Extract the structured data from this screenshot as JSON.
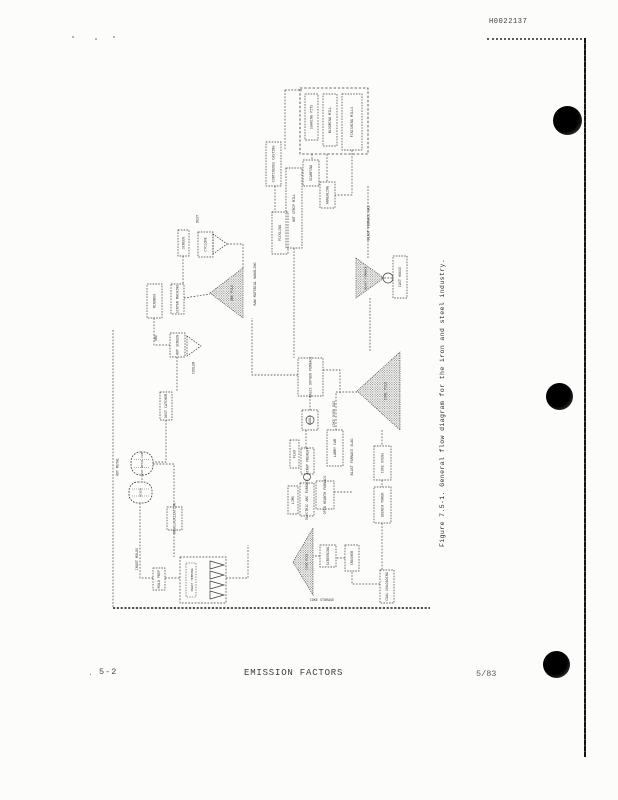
{
  "page": {
    "stamp": "H0022137",
    "caption": "Figure 7.5-1.  General flow diagram for the iron and steel industry.",
    "footer": {
      "stray": ".",
      "left": "5-2",
      "center": "EMISSION FACTORS",
      "right": "5/83"
    }
  },
  "colors": {
    "ink": "#3a3a3a",
    "paper": "#fcfcfb",
    "hole": "#1c1c1c"
  },
  "diagram": {
    "title": "General flow diagram for the iron and steel industry",
    "nodes": [
      {
        "id": "finishing-enclosure",
        "type": "enclosure",
        "x": 300,
        "y": 88,
        "w": 68,
        "h": 66
      },
      {
        "id": "soaking-pits",
        "type": "box",
        "x": 305,
        "y": 94,
        "w": 13,
        "h": 46,
        "label": "SOAKING PITS"
      },
      {
        "id": "blooming-mill",
        "type": "box",
        "x": 323,
        "y": 94,
        "w": 14,
        "h": 52,
        "label": "BLOOMING MILL"
      },
      {
        "id": "finishing-mills",
        "type": "box",
        "x": 342,
        "y": 94,
        "w": 20,
        "h": 56,
        "label": "FINISHING MILLS"
      },
      {
        "id": "scarfing",
        "type": "box",
        "x": 303,
        "y": 160,
        "w": 16,
        "h": 26,
        "label": "SCARFING"
      },
      {
        "id": "continuous-casting",
        "type": "box",
        "x": 266,
        "y": 142,
        "w": 15,
        "h": 44,
        "label": "CONTINUOUS CASTING"
      },
      {
        "id": "hot-strip-mill",
        "type": "box",
        "x": 286,
        "y": 168,
        "w": 16,
        "h": 80,
        "label": "HOT STRIP MILL"
      },
      {
        "id": "pickling",
        "type": "box",
        "x": 272,
        "y": 212,
        "w": 16,
        "h": 42,
        "label": "PICKLING"
      },
      {
        "id": "annealing",
        "type": "box",
        "x": 320,
        "y": 182,
        "w": 15,
        "h": 26,
        "label": "ANNEALING"
      },
      {
        "id": "dust-label",
        "type": "text",
        "x": 193,
        "y": 208,
        "w": 9,
        "h": 22,
        "label": "DUST"
      },
      {
        "id": "cyclone",
        "type": "box",
        "x": 198,
        "y": 232,
        "w": 15,
        "h": 25,
        "label": "CYCLONE"
      },
      {
        "id": "cyclone-cone",
        "type": "funnel",
        "points": [
          [
            213,
            234
          ],
          [
            213,
            254
          ],
          [
            227,
            244
          ]
        ]
      },
      {
        "id": "screen",
        "type": "box",
        "x": 178,
        "y": 230,
        "w": 11,
        "h": 26,
        "label": "SCREEN"
      },
      {
        "id": "windbox",
        "type": "box",
        "x": 147,
        "y": 284,
        "w": 15,
        "h": 34,
        "label": "WINDBOX"
      },
      {
        "id": "sinter-machine",
        "type": "box",
        "x": 171,
        "y": 284,
        "w": 13,
        "h": 30,
        "label": "SINTER MACHINE"
      },
      {
        "id": "ore-label",
        "type": "text",
        "x": 152,
        "y": 328,
        "w": 8,
        "h": 20,
        "label": "ORE"
      },
      {
        "id": "hot-screen",
        "type": "box",
        "x": 170,
        "y": 333,
        "w": 15,
        "h": 24,
        "label": "HOT SCREEN"
      },
      {
        "id": "sinter-cooler-cone",
        "type": "funnel",
        "points": [
          [
            187,
            336
          ],
          [
            187,
            356
          ],
          [
            201,
            346
          ]
        ]
      },
      {
        "id": "cooler-label",
        "type": "text",
        "x": 190,
        "y": 358,
        "w": 7,
        "h": 20,
        "label": "COOLER"
      },
      {
        "id": "ore-pile",
        "type": "pile",
        "points": [
          [
            210,
            293
          ],
          [
            243,
            268
          ],
          [
            243,
            318
          ]
        ],
        "label": "ORE PILE"
      },
      {
        "id": "material-handling-label",
        "type": "text",
        "x": 251,
        "y": 255,
        "w": 8,
        "h": 58,
        "label": "RAW MATERIAL HANDLING"
      },
      {
        "id": "blast-furnace",
        "type": "pile",
        "points": [
          [
            356,
            258
          ],
          [
            356,
            298
          ],
          [
            384,
            278
          ]
        ],
        "label": "BLAST FURNACE",
        "fs": 3
      },
      {
        "id": "hot-metal-circle",
        "type": "circle",
        "cx": 388,
        "cy": 278,
        "r": 5
      },
      {
        "id": "cast-house",
        "type": "box",
        "x": 393,
        "y": 256,
        "w": 14,
        "h": 42,
        "label": "CAST HOUSE"
      },
      {
        "id": "bf-gas-label",
        "type": "text",
        "x": 364,
        "y": 192,
        "w": 9,
        "h": 62,
        "label": "BLAST FURNACE GAS"
      },
      {
        "id": "dust-catcher",
        "type": "box",
        "x": 160,
        "y": 392,
        "w": 12,
        "h": 28,
        "label": "DUST CATCHER"
      },
      {
        "id": "coal-pile",
        "type": "pile",
        "points": [
          [
            357,
            391
          ],
          [
            400,
            352
          ],
          [
            400,
            430
          ]
        ],
        "label": "COAL PILE"
      },
      {
        "id": "larry-car",
        "type": "box",
        "x": 327,
        "y": 430,
        "w": 16,
        "h": 36,
        "label": "LARRY CAR"
      },
      {
        "id": "coke-ovens",
        "type": "box",
        "x": 374,
        "y": 446,
        "w": 17,
        "h": 34,
        "label": "COKE OVENS"
      },
      {
        "id": "quench-tower",
        "type": "box",
        "x": 374,
        "y": 487,
        "w": 17,
        "h": 36,
        "label": "QUENCH TOWER"
      },
      {
        "id": "coal-unloading",
        "type": "box",
        "x": 380,
        "y": 570,
        "w": 14,
        "h": 33,
        "label": "COAL UNLOADING"
      },
      {
        "id": "crusher",
        "type": "box",
        "x": 345,
        "y": 545,
        "w": 14,
        "h": 26,
        "label": "CRUSHER"
      },
      {
        "id": "screening",
        "type": "box",
        "x": 320,
        "y": 545,
        "w": 16,
        "h": 22,
        "label": "SCREENING"
      },
      {
        "id": "coke-pile",
        "type": "pile",
        "points": [
          [
            293,
            562
          ],
          [
            313,
            528
          ],
          [
            313,
            595
          ]
        ],
        "label": "COKE PILE",
        "fs": 3
      },
      {
        "id": "coke-storage-label",
        "type": "text",
        "x": 300,
        "y": 596,
        "w": 44,
        "h": 8,
        "label": "COKE STORAGE",
        "orient": "h",
        "fs": 3.4
      },
      {
        "id": "bof",
        "type": "box",
        "x": 298,
        "y": 358,
        "w": 25,
        "h": 38,
        "label": "BASIC OXYGEN FURNACE"
      },
      {
        "id": "ladle",
        "type": "box",
        "x": 302,
        "y": 410,
        "w": 16,
        "h": 20,
        "label": "LADLE"
      },
      {
        "id": "ladle-circle",
        "type": "circle",
        "cx": 310,
        "cy": 420,
        "r": 4
      },
      {
        "id": "coke-oven-gas-label",
        "type": "text",
        "x": 330,
        "y": 393,
        "w": 8,
        "h": 42,
        "label": "COKE OVEN GAS"
      },
      {
        "id": "bf-slag-label",
        "type": "text",
        "x": 348,
        "y": 427,
        "w": 8,
        "h": 60,
        "label": "BLAST FURNACE SLAG"
      },
      {
        "id": "flux",
        "type": "box",
        "x": 290,
        "y": 440,
        "w": 9,
        "h": 28,
        "label": "FLUX"
      },
      {
        "id": "scrap-preheat",
        "type": "box",
        "x": 301,
        "y": 448,
        "w": 13,
        "h": 26,
        "label": "SCRAP PREHEAT"
      },
      {
        "id": "transfer-circle",
        "type": "circle",
        "cx": 307,
        "cy": 477,
        "r": 3.5
      },
      {
        "id": "lime",
        "type": "box",
        "x": 288,
        "y": 486,
        "w": 10,
        "h": 28,
        "label": "LIME"
      },
      {
        "id": "electric-arc-furnace",
        "type": "box",
        "x": 300,
        "y": 483,
        "w": 14,
        "h": 33,
        "label": "ELECTRIC ARC FURNACE"
      },
      {
        "id": "open-hearth-furnace",
        "type": "box",
        "x": 316,
        "y": 481,
        "w": 18,
        "h": 28,
        "label": "OPEN HEARTH FURNACE"
      },
      {
        "id": "hot-metal-car",
        "type": "ladle",
        "x": 131,
        "y": 452,
        "w": 22,
        "h": 23,
        "label": "HOT METAL CAR"
      },
      {
        "id": "mixer",
        "type": "ladle",
        "x": 129,
        "y": 482,
        "w": 23,
        "h": 21,
        "label": "MIXER"
      },
      {
        "id": "hot-metal-label",
        "type": "text",
        "x": 113,
        "y": 450,
        "w": 9,
        "h": 34,
        "label": "HOT METAL"
      },
      {
        "id": "desulfurization",
        "type": "box",
        "x": 167,
        "y": 507,
        "w": 15,
        "h": 23,
        "label": "DESULFURIZATION"
      },
      {
        "id": "ingot-molds-label",
        "type": "text",
        "x": 133,
        "y": 545,
        "w": 8,
        "h": 28,
        "label": "INGOT MOLDS"
      },
      {
        "id": "mold-prep",
        "type": "box",
        "x": 153,
        "y": 568,
        "w": 12,
        "h": 22,
        "label": "MOLD PREP"
      },
      {
        "id": "ingot-teeming",
        "type": "ingots",
        "x": 180,
        "y": 557,
        "w": 46,
        "h": 46,
        "label": "INGOT TEEMING"
      }
    ],
    "edges": [
      {
        "points": [
          [
            285,
            90
          ],
          [
            302,
            90
          ]
        ]
      },
      {
        "points": [
          [
            285,
            90
          ],
          [
            285,
            150
          ]
        ]
      },
      {
        "points": [
          [
            312,
            154
          ],
          [
            312,
            160
          ]
        ]
      },
      {
        "points": [
          [
            294,
            248
          ],
          [
            294,
            358
          ]
        ]
      },
      {
        "points": [
          [
            352,
            150
          ],
          [
            352,
            195
          ],
          [
            335,
            195
          ]
        ]
      },
      {
        "points": [
          [
            327,
            154
          ],
          [
            327,
            182
          ]
        ]
      },
      {
        "points": [
          [
            275,
            186
          ],
          [
            275,
            212
          ]
        ]
      },
      {
        "points": [
          [
            227,
            244
          ],
          [
            243,
            244
          ],
          [
            243,
            268
          ]
        ]
      },
      {
        "points": [
          [
            184,
            298
          ],
          [
            210,
            294
          ]
        ]
      },
      {
        "points": [
          [
            154,
            318
          ],
          [
            154,
            345
          ],
          [
            170,
            345
          ]
        ]
      },
      {
        "points": [
          [
            177,
            357
          ],
          [
            177,
            392
          ]
        ]
      },
      {
        "points": [
          [
            166,
            420
          ],
          [
            166,
            462
          ],
          [
            153,
            462
          ]
        ]
      },
      {
        "points": [
          [
            142,
            475
          ],
          [
            142,
            482
          ]
        ]
      },
      {
        "points": [
          [
            140,
            503
          ],
          [
            140,
            578
          ],
          [
            153,
            578
          ]
        ]
      },
      {
        "points": [
          [
            153,
            464
          ],
          [
            174,
            464
          ],
          [
            174,
            507
          ]
        ]
      },
      {
        "points": [
          [
            174,
            530
          ],
          [
            174,
            557
          ]
        ]
      },
      {
        "points": [
          [
            165,
            578
          ],
          [
            180,
            578
          ]
        ]
      },
      {
        "points": [
          [
            226,
            578
          ],
          [
            248,
            578
          ],
          [
            248,
            545
          ]
        ]
      },
      {
        "points": [
          [
            113,
            608
          ],
          [
            430,
            608
          ]
        ],
        "heavy": true
      },
      {
        "points": [
          [
            113,
            330
          ],
          [
            113,
            608
          ]
        ]
      },
      {
        "points": [
          [
            368,
            186
          ],
          [
            368,
            258
          ]
        ]
      },
      {
        "points": [
          [
            370,
            298
          ],
          [
            370,
            352
          ]
        ]
      },
      {
        "points": [
          [
            381,
            278
          ],
          [
            393,
            278
          ]
        ]
      },
      {
        "points": [
          [
            357,
            392
          ],
          [
            336,
            392
          ],
          [
            336,
            430
          ]
        ]
      },
      {
        "points": [
          [
            382,
            430
          ],
          [
            382,
            446
          ]
        ]
      },
      {
        "points": [
          [
            382,
            480
          ],
          [
            382,
            487
          ]
        ]
      },
      {
        "points": [
          [
            382,
            523
          ],
          [
            382,
            570
          ]
        ]
      },
      {
        "points": [
          [
            380,
            584
          ],
          [
            352,
            584
          ],
          [
            352,
            571
          ]
        ]
      },
      {
        "points": [
          [
            345,
            558
          ],
          [
            336,
            558
          ]
        ]
      },
      {
        "points": [
          [
            320,
            556
          ],
          [
            313,
            556
          ]
        ]
      },
      {
        "points": [
          [
            310,
            396
          ],
          [
            310,
            410
          ]
        ]
      },
      {
        "points": [
          [
            306,
            430
          ],
          [
            306,
            448
          ]
        ]
      },
      {
        "points": [
          [
            298,
            375
          ],
          [
            252,
            375
          ],
          [
            252,
            318
          ]
        ]
      },
      {
        "points": [
          [
            323,
            370
          ],
          [
            340,
            370
          ],
          [
            340,
            394
          ]
        ]
      },
      {
        "points": [
          [
            334,
            492
          ],
          [
            352,
            492
          ]
        ]
      },
      {
        "points": [
          [
            183,
            256
          ],
          [
            183,
            284
          ]
        ]
      }
    ]
  }
}
